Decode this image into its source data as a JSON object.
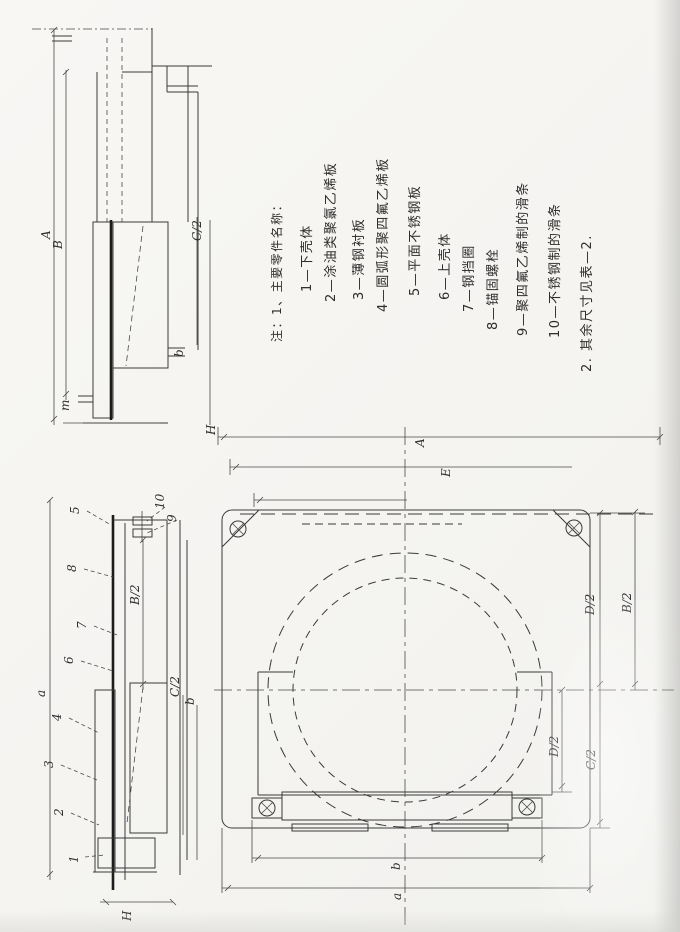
{
  "parts_list": {
    "header": "注：1、主要零件名称：",
    "items": [
      "1—下壳体",
      "2—涂油类聚氯乙烯板",
      "3—薄钢衬板",
      "4—圆弧形聚四氟乙烯板",
      "5—平面不锈钢板",
      "6—上壳体",
      "7—钢挡圈",
      "8—锚固螺栓",
      "9—聚四氟乙烯制的滑条",
      "10—不锈钢制的滑条"
    ],
    "footer": "2. 其余尺寸见表—2."
  },
  "side_view_top": {
    "dim_A": "A",
    "dim_B": "B",
    "dim_C_half": "C/2",
    "dim_b": "b",
    "dim_m": "m",
    "dim_H": "H"
  },
  "side_view_bottom": {
    "callouts": [
      "1",
      "2",
      "3",
      "4",
      "5",
      "6",
      "7",
      "8",
      "9",
      "10"
    ],
    "dim_a": "a",
    "dim_B_half": "B/2",
    "dim_C_half": "C/2",
    "dim_b": "b",
    "dim_H": "H"
  },
  "plan_view": {
    "dim_A": "A",
    "dim_E": "E",
    "dim_B_half": "B/2",
    "dim_D_half_upper": "D/2",
    "dim_D_half_lower": "D/2",
    "dim_C_half": "C/2",
    "dim_b": "b",
    "dim_a": "a"
  },
  "colors": {
    "ink": "#3a3a3a",
    "paper": "#f7f6f3",
    "shade": "#d9d9d6"
  }
}
